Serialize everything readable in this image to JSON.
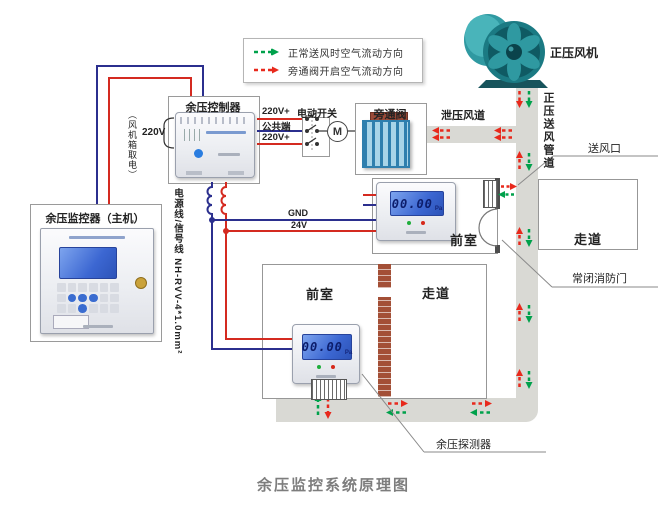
{
  "title": "余压监控系统原理图",
  "legend": {
    "normal_flow": "正常送风时空气流动方向",
    "bypass_flow": "旁通阀开启空气流动方向"
  },
  "fan": {
    "label": "正压风机"
  },
  "ducts": {
    "supply_vertical": "正压送风管道",
    "relief": "泄压风道",
    "air_outlet": "送风口"
  },
  "upper_floor": {
    "front_room": "前室",
    "corridor": "走道",
    "fire_door": "常闭消防门"
  },
  "lower_floor": {
    "front_room": "前室",
    "corridor": "走道",
    "detector_label": "余压探测器"
  },
  "monitor": {
    "name": "余压监控器（主机）"
  },
  "controller": {
    "name": "余压控制器",
    "power_label": "220V",
    "power_note": "（风机箱取电）",
    "cable_note": "电源线/信号线 NH-RVV-4*1.0mm²",
    "wire_220v_a": "220V+",
    "wire_common": "公共端",
    "wire_220v_b": "220V+",
    "wire_gnd": "GND",
    "wire_24v": "24V"
  },
  "bypass": {
    "switch_label": "电动开关",
    "valve_label": "旁通阀",
    "motor": "M"
  },
  "detector": {
    "lcd_value": "00.00",
    "lcd_unit": "Pa"
  },
  "colors": {
    "supply_green": "#00a14b",
    "bypass_red": "#e8291c",
    "wire_red": "#d42a20",
    "wire_blue": "#2b2f8e",
    "duct_gray": "#d9d9d4",
    "fan_teal": "#2a9098"
  }
}
